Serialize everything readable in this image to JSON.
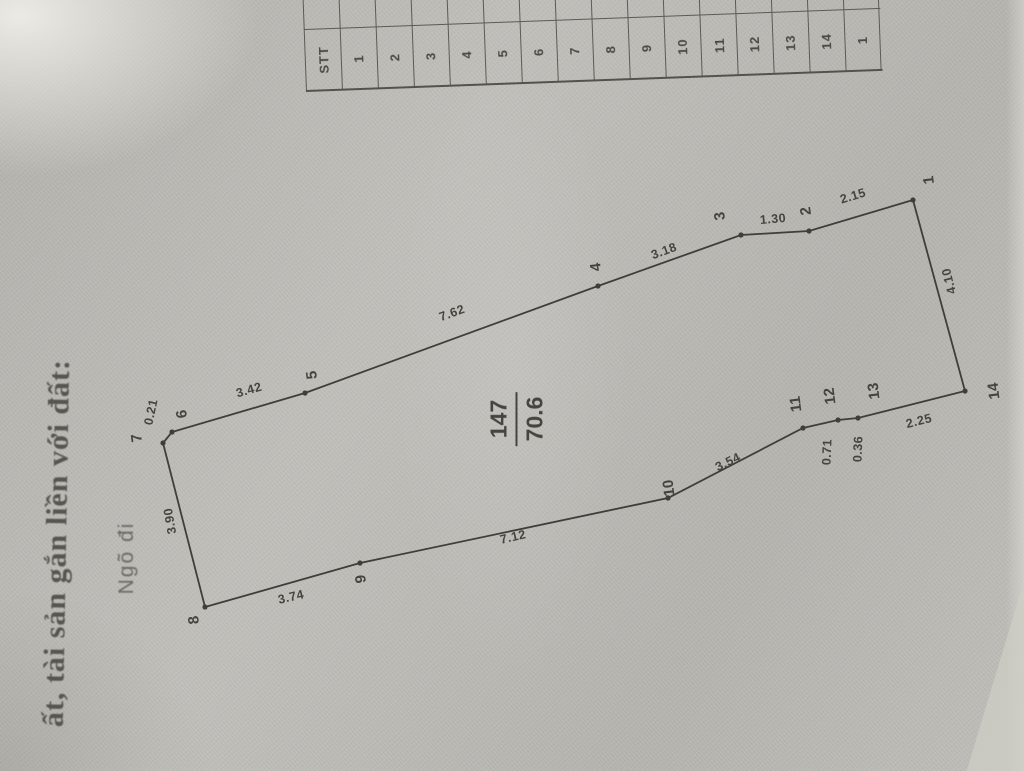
{
  "page": {
    "paper_color": "#bdbcb7",
    "ink_color": "#3f3e39",
    "side_text": "ất, tài sản gắn liền với đất:",
    "alley_label": "Ngõ đi"
  },
  "table": {
    "cells": [
      "STT",
      "1",
      "2",
      "3",
      "4",
      "5",
      "6",
      "7",
      "8",
      "9",
      "10",
      "11",
      "12",
      "13",
      "14",
      "1"
    ]
  },
  "parcel": {
    "number": "147",
    "area": "70.6",
    "vertices": [
      {
        "id": "1",
        "x": 913,
        "y": 200,
        "lx": 929,
        "ly": 180
      },
      {
        "id": "2",
        "x": 809,
        "y": 231,
        "lx": 806,
        "ly": 211
      },
      {
        "id": "3",
        "x": 741,
        "y": 235,
        "lx": 720,
        "ly": 216
      },
      {
        "id": "4",
        "x": 598,
        "y": 286,
        "lx": 596,
        "ly": 267
      },
      {
        "id": "5",
        "x": 305,
        "y": 393,
        "lx": 312,
        "ly": 375
      },
      {
        "id": "6",
        "x": 172,
        "y": 432,
        "lx": 182,
        "ly": 414
      },
      {
        "id": "7",
        "x": 163,
        "y": 443,
        "lx": 137,
        "ly": 438
      },
      {
        "id": "8",
        "x": 205,
        "y": 607,
        "lx": 194,
        "ly": 620
      },
      {
        "id": "9",
        "x": 360,
        "y": 563,
        "lx": 361,
        "ly": 579
      },
      {
        "id": "10",
        "x": 668,
        "y": 498,
        "lx": 669,
        "ly": 488
      },
      {
        "id": "11",
        "x": 803,
        "y": 428,
        "lx": 796,
        "ly": 404
      },
      {
        "id": "12",
        "x": 838,
        "y": 420,
        "lx": 830,
        "ly": 396
      },
      {
        "id": "13",
        "x": 858,
        "y": 418,
        "lx": 874,
        "ly": 391
      },
      {
        "id": "14",
        "x": 965,
        "y": 391,
        "lx": 994,
        "ly": 391
      }
    ],
    "edges": [
      {
        "from": "1",
        "to": "2",
        "length": "2.15",
        "x": 853,
        "y": 196,
        "angle": -17
      },
      {
        "from": "2",
        "to": "3",
        "length": "1.30",
        "x": 773,
        "y": 219,
        "angle": -5
      },
      {
        "from": "3",
        "to": "4",
        "length": "3.18",
        "x": 664,
        "y": 251,
        "angle": -20
      },
      {
        "from": "4",
        "to": "5",
        "length": "7.62",
        "x": 452,
        "y": 313,
        "angle": -20
      },
      {
        "from": "5",
        "to": "6",
        "length": "3.42",
        "x": 249,
        "y": 390,
        "angle": -16
      },
      {
        "from": "6",
        "to": "7",
        "length": "0.21",
        "x": 151,
        "y": 412,
        "angle": -78
      },
      {
        "from": "7",
        "to": "8",
        "length": "3.90",
        "x": 170,
        "y": 521,
        "angle": -100
      },
      {
        "from": "8",
        "to": "9",
        "length": "3.74",
        "x": 291,
        "y": 597,
        "angle": -13
      },
      {
        "from": "9",
        "to": "10",
        "length": "7.12",
        "x": 513,
        "y": 537,
        "angle": -13
      },
      {
        "from": "10",
        "to": "11",
        "length": "3.54",
        "x": 728,
        "y": 462,
        "angle": -26
      },
      {
        "from": "11",
        "to": "12",
        "length": "0.71",
        "x": 827,
        "y": 452,
        "angle": -88
      },
      {
        "from": "12",
        "to": "13",
        "length": "0.36",
        "x": 858,
        "y": 449,
        "angle": -88
      },
      {
        "from": "13",
        "to": "14",
        "length": "2.25",
        "x": 919,
        "y": 421,
        "angle": -14
      },
      {
        "from": "14",
        "to": "1",
        "length": "4.10",
        "x": 949,
        "y": 281,
        "angle": -104
      }
    ]
  }
}
